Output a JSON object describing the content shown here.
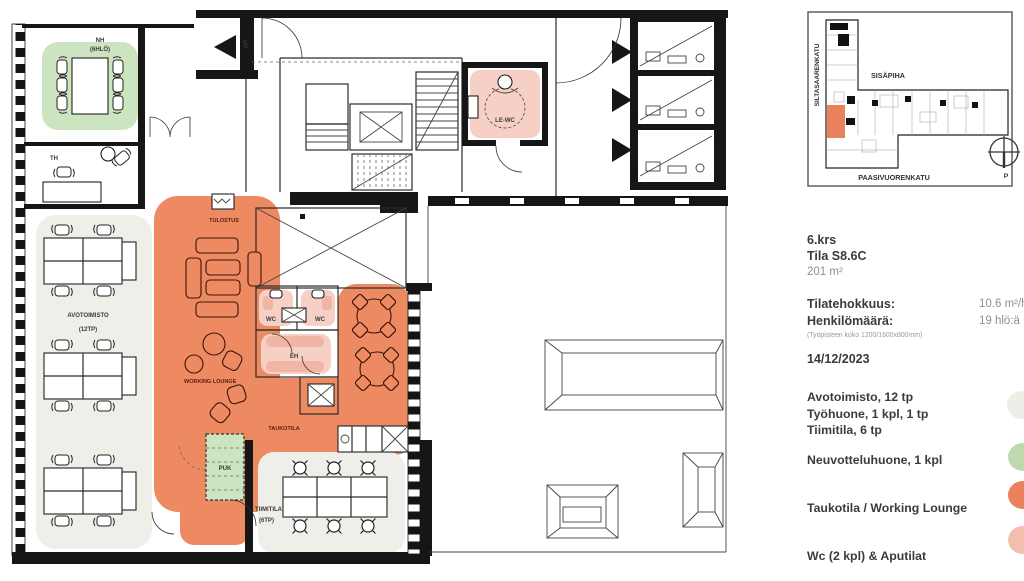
{
  "plan": {
    "labels": {
      "nh": "NH",
      "nh_cap": "(6HLÖ)",
      "th": "TH",
      "avotoimisto_1": "AVOTOIMISTO",
      "avotoimisto_2": "(12TP)",
      "tulostus": "TULOSTUS",
      "lounge": "WORKING LOUNGE",
      "wc1": "WC",
      "wc2": "WC",
      "eh": "EH",
      "taukotila": "TAUKOTILA",
      "puk": "PUK",
      "tiimitila_1": "TIIMITILA",
      "tiimitila_2": "(6TP)",
      "lewc": "LE-WC",
      "up": "UP"
    }
  },
  "minimap": {
    "street_left": "SILTASAARENKATU",
    "courtyard": "SISÄPIHA",
    "street_bottom": "PAASIVUORENKATU",
    "compass": "P"
  },
  "info": {
    "floor": "6.krs",
    "space": "Tila S8.6C",
    "area": "201 m²",
    "efficiency_label": "Tilatehokkuus:",
    "efficiency_value": "10.6 m²/h",
    "headcount_label": "Henkilömäärä:",
    "headcount_value": "19 hlö:ä",
    "note": "(Työpisteen koko 1200/1600x800mm)",
    "date": "14/12/2023",
    "legend": [
      {
        "lines": [
          "Avotoimisto, 12 tp",
          "Työhuone, 1 kpl, 1 tp",
          "Tiimitila, 6 tp"
        ],
        "color": "#efede8"
      },
      {
        "lines": [
          "Neuvotteluhuone, 1 kpl"
        ],
        "color": "#bdd9ad"
      },
      {
        "lines": [
          "Taukotila / Working Lounge"
        ],
        "color": "#e9815b"
      },
      {
        "lines": [
          "Wc (2 kpl) & Aputilat"
        ],
        "color": "#f2bfae"
      }
    ]
  },
  "colors": {
    "zone_open_office": "#f0eee9",
    "zone_meeting": "#cde4c0",
    "zone_lounge": "#ee8a61",
    "zone_wc": "#f6d0c4",
    "zone_wc_dark": "#f0b5a5",
    "walls": "#161616"
  }
}
